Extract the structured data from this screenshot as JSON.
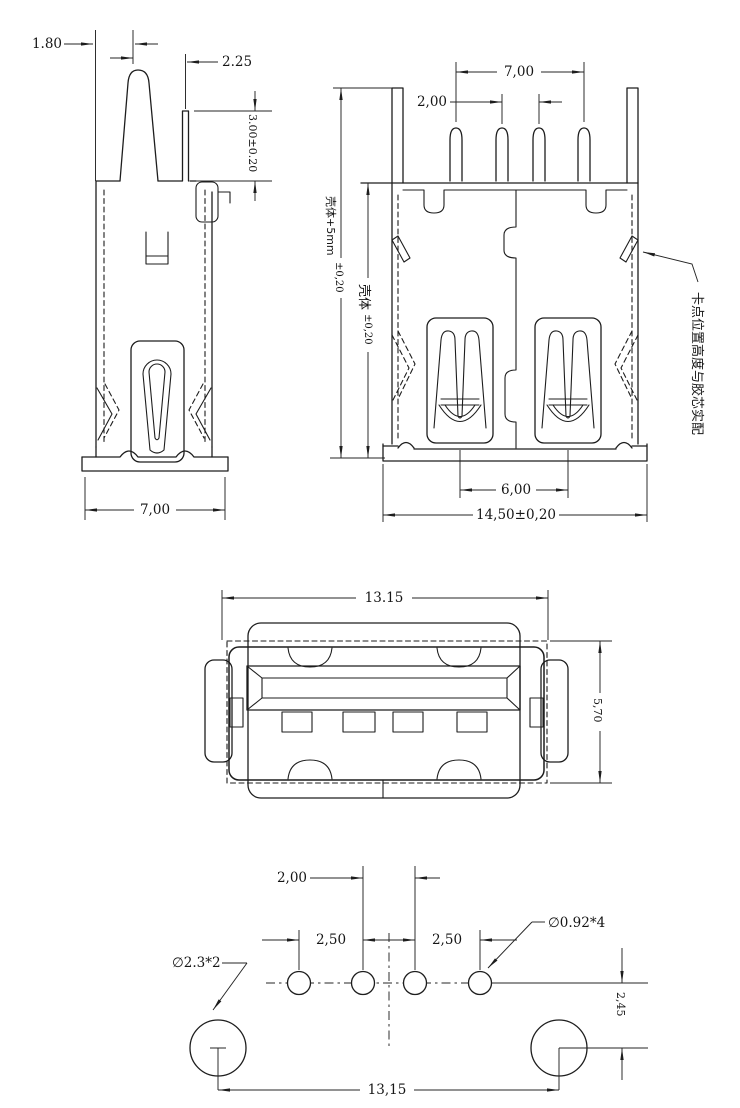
{
  "colors": {
    "line": "#1d1d1d",
    "background": "#ffffff"
  },
  "side": {
    "d180": "1.80",
    "d225": "2.25",
    "d300": "3.00±0.20",
    "d700": "7,00"
  },
  "rear": {
    "d700": "7,00",
    "d200": "2,00",
    "shell_outer": "壳体+5mm",
    "shell_outer_tol": "±0,20",
    "shell_inner": "壳体",
    "shell_inner_tol": "±0,20",
    "d600": "6,00",
    "d1450": "14,50±0,20",
    "note": "卡点位置高度与胶芯实配"
  },
  "front": {
    "d1315": "13.15",
    "d570": "5,70"
  },
  "footprint": {
    "d200": "2,00",
    "d250l": "2,50",
    "d250r": "2,50",
    "small_holes": "∅0.92*4",
    "big_holes": "∅2.3*2",
    "d245": "2,45",
    "d1315": "13,15"
  }
}
